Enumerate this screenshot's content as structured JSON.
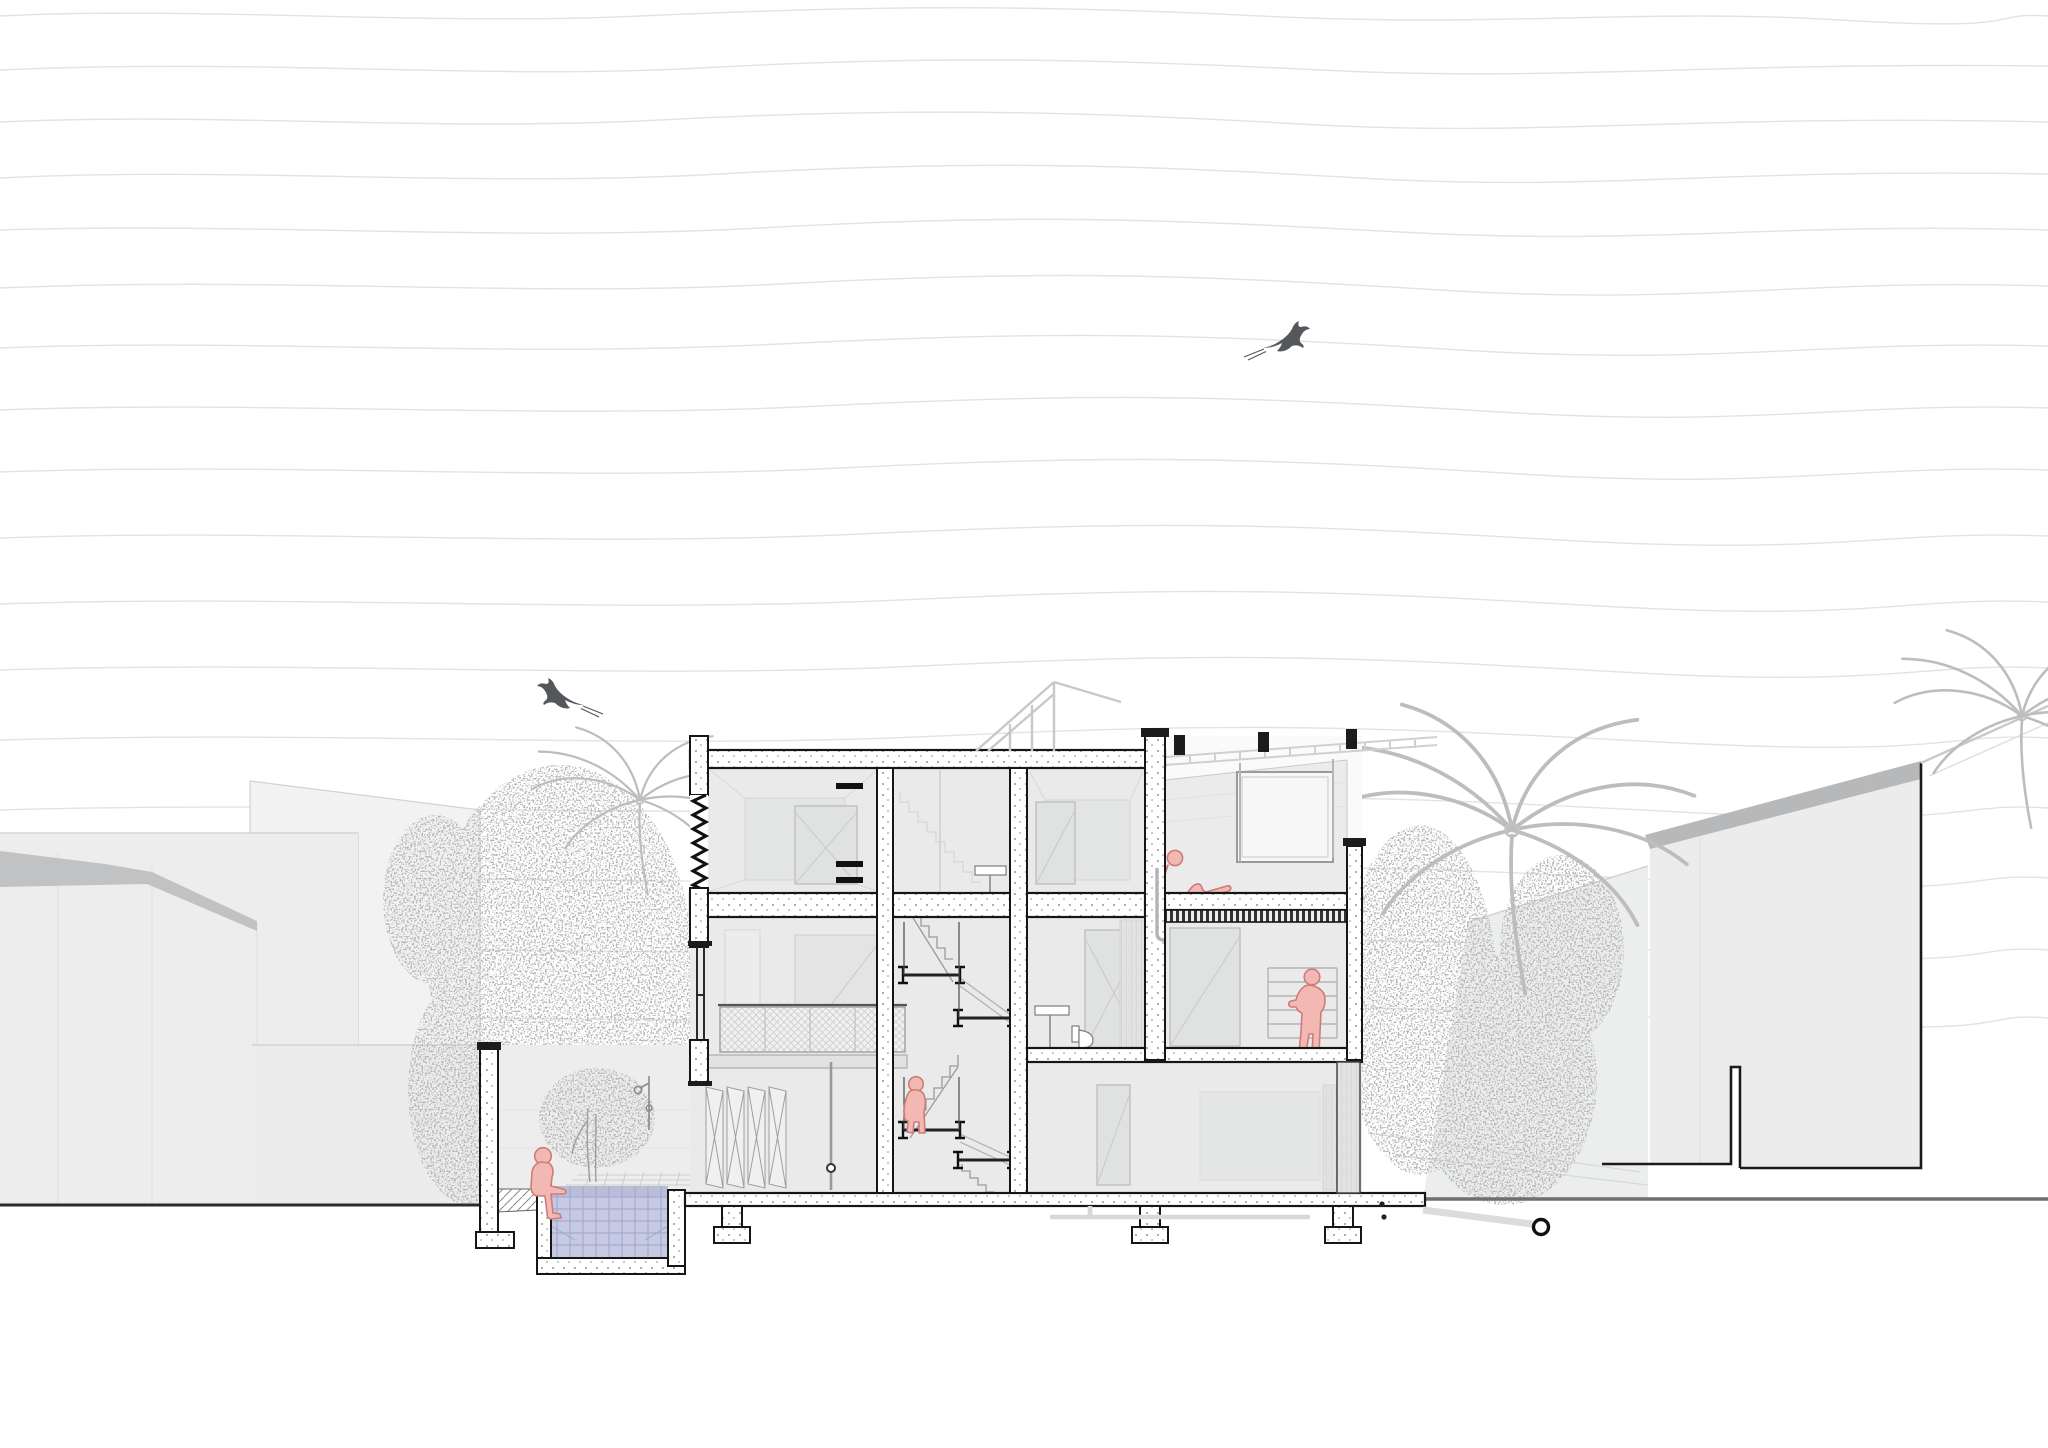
{
  "scene": {
    "description": "Architectural cross-section drawing of a three-storey house set between neighbouring grey buildings, with a courtyard swimming pool, garden tree, outdoor shower, palm trees, wavy sky contour lines and two swallows",
    "drawing_style": "section line drawing with stippled cut walls",
    "floors_visible": 3,
    "figure_count": 4,
    "bird_count": 2
  },
  "palette": {
    "paper": "#ffffff",
    "contour": "#e3e3e3",
    "interior": "#eaeaea",
    "interior_dark": "#e3e4e4",
    "neighbor": "#ededed",
    "roof_band": "#c1c2c3",
    "roof_band_right": "#b7b8b9",
    "vegetation": "#bdbdbd",
    "truss": "#c8c8c8",
    "figure_fill": "#f3b8b4",
    "figure_stroke": "#cb7d78",
    "water_fill": "#c7cae3",
    "water_grid": "#9ea3cb",
    "stipple_dot": "#8c8c8c",
    "ground_line": "#2b2b2b",
    "section_line": "#161616"
  },
  "figures": [
    {
      "name": "figure-sitting-pool-edge",
      "pose": "seated on pool coping with feet in the water"
    },
    {
      "name": "figure-on-stair-landing",
      "pose": "standing on the central stair landing"
    },
    {
      "name": "figure-standing-shelf-room",
      "pose": "standing by shelving with arm outstretched"
    },
    {
      "name": "figure-reclining-terrace",
      "pose": "reclining on the covered roof terrace"
    }
  ],
  "birds": [
    {
      "name": "swallow-upper-sky",
      "heading": "right"
    },
    {
      "name": "swallow-lower-sky",
      "heading": "left"
    }
  ],
  "pool": {
    "water_color": "#c7cae3",
    "grid_color": "#9ea3cb",
    "has_underwater_grid": true
  },
  "vegetation": {
    "palm_trees": 3,
    "tree_clusters": 2,
    "courtyard_tree": 1,
    "color": "#bdbdbd"
  },
  "site": {
    "left_neighbor_buildings": 2,
    "right_neighbor_buildings": 1,
    "boundary_wall": true,
    "outdoor_shower": true,
    "drain_outlet": true,
    "roof_elements": [
      "skylight truss",
      "terrace pergola",
      "parapet"
    ]
  }
}
